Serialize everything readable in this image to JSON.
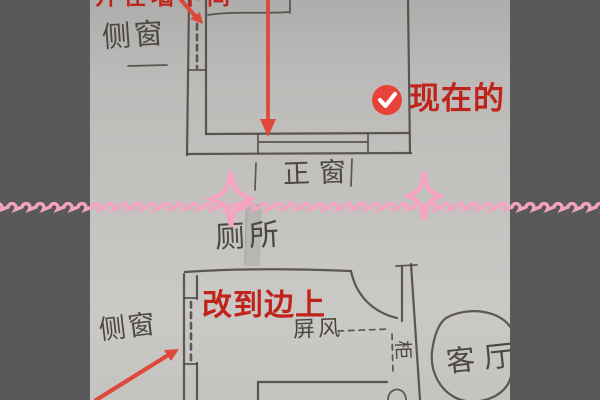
{
  "photo": {
    "upper_plan": {
      "top_note": "开在墙中间",
      "side_window_label": "侧窗",
      "main_window_label": "正窗",
      "status_label": "现在的"
    },
    "between": {
      "toilet_label": "厕所"
    },
    "lower_plan": {
      "change_note": "改到边上",
      "side_window_label": "侧窗",
      "screen_label": "屏风",
      "cabinet_label": "柜",
      "living_room_label": "客厅"
    }
  },
  "colors": {
    "backdrop": "#59585a",
    "pencil": "#4b4843",
    "annotation_red": "#c0231b",
    "arrow_red": "#dd4a3c",
    "badge_red": "#e8433a",
    "decor_pink": "#f5a3c0"
  }
}
